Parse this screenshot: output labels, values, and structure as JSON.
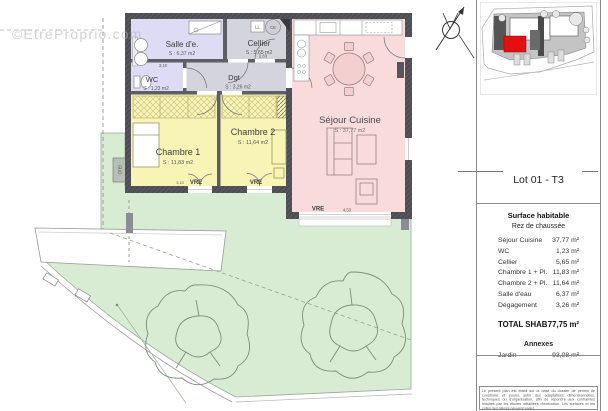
{
  "watermark": "©EtreProprio.com",
  "plan": {
    "rooms": {
      "salle_deau": {
        "name": "Salle d'e.",
        "area": "S : 6,37 m2"
      },
      "cellier": {
        "name": "Cellier",
        "area": "S : 5,65 m2"
      },
      "wc": {
        "name": "WC",
        "area": "S : 1,23 m2"
      },
      "dgt": {
        "name": "Dgt",
        "area": "S : 3,26 m2"
      },
      "chambre1": {
        "name": "Chambre 1",
        "area": "S : 11,83 m2"
      },
      "chambre2": {
        "name": "Chambre 2",
        "area": "S : 11,64 m2"
      },
      "sejour": {
        "name": "Séjour Cuisine",
        "area": "S : 37,77 m2"
      }
    },
    "labels": {
      "window": "VRE",
      "washing_machine": "LL",
      "water_heater": "CE",
      "elec_box": "Cf El"
    },
    "dimensions": {
      "salle_deau_width": "3,10",
      "cellier_width": "2,83",
      "salle_deau_depth": "2,08",
      "sejour_window_width": "4,53",
      "chambre1_width": "3,10"
    }
  },
  "panel": {
    "lot_title": "Lot 01 - T3",
    "surface_title": "Surface habitable",
    "floor_label": "Rez de chaussée",
    "rows": [
      {
        "label": "Séjour Cuisine",
        "value": "37,77 m²"
      },
      {
        "label": "WC",
        "value": "1,23 m²"
      },
      {
        "label": "Cellier",
        "value": "5,65 m²"
      },
      {
        "label": "Chambre 1 + Pl.",
        "value": "11,83 m²"
      },
      {
        "label": "Chambre 2 + Pl.",
        "value": "11,64 m²"
      },
      {
        "label": "Salle d'eau",
        "value": "6,37 m²"
      },
      {
        "label": "Dégagement",
        "value": "3,26 m²"
      }
    ],
    "total_label": "TOTAL SHAB",
    "total_value": "77,75 m²",
    "annexes_title": "Annexes",
    "annex_rows": [
      {
        "label": "Jardin",
        "value": "93,08 m²"
      }
    ],
    "disclaimer": "Le présent plan est établi sur la base du dossier de permis de construire et pourra subir des adaptations dimensionnelles, techniques ou d'organisation, afin de répondre aux contraintes induites par les études détaillées d'exécution. Les surfaces et les cotes des pièces peuvent varier."
  },
  "colors": {
    "wall": "#55555b",
    "garden": "#d8ecd3",
    "bedroom": "#f8f4b6",
    "living": "#f9dbdb",
    "service": "#d4d4dc",
    "bathroom": "#dddcf4",
    "lot_highlight": "#e21010"
  }
}
